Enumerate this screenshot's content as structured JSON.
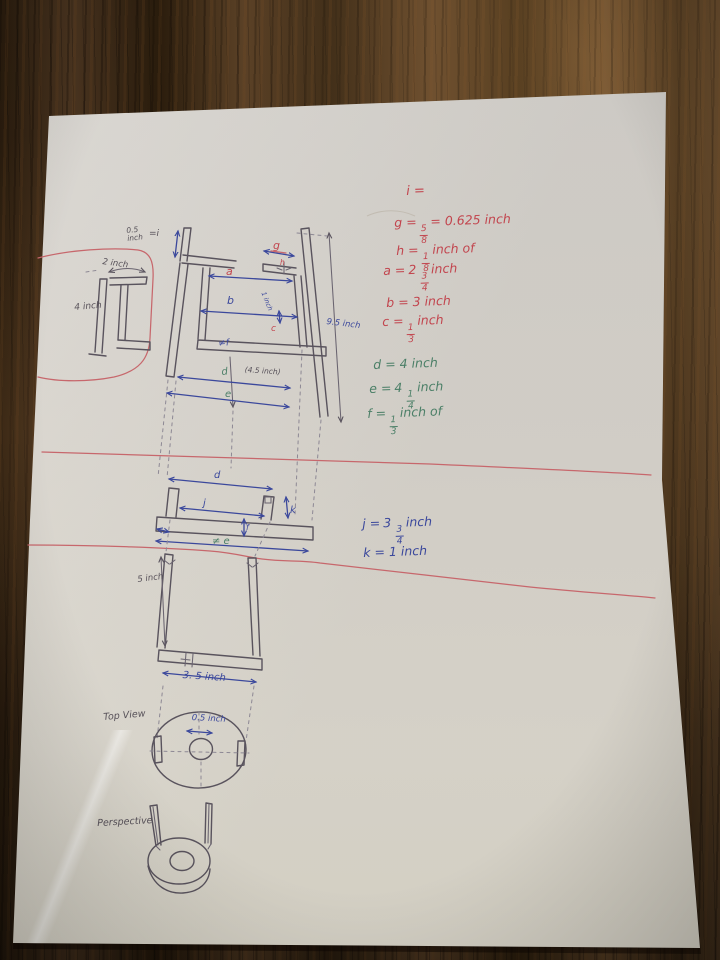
{
  "colors": {
    "ink": "#59535d",
    "dimension_blue": "#3b489c",
    "legend_red": "#c2454e",
    "legend_green": "#4b7f67",
    "red_marker_line": "#c7676c",
    "paper": "#dcd8d1",
    "wood": "#3a2a1a"
  },
  "legend": {
    "red": {
      "i": {
        "pre": "i ="
      },
      "g": {
        "pre": "g =",
        "num": "5",
        "den": "8",
        "post": "= 0.625 inch"
      },
      "h": {
        "pre": "h =",
        "num": "1",
        "den": "8",
        "post": "inch of"
      },
      "a": {
        "pre": "a =",
        "whole": "2",
        "num": "3",
        "den": "4",
        "post": "inch"
      },
      "b": {
        "pre": "b =",
        "post": "3 inch"
      },
      "c": {
        "pre": "c =",
        "num": "1",
        "den": "3",
        "post": "inch"
      }
    },
    "green": {
      "d": {
        "pre": "d =",
        "post": "4 inch"
      },
      "e": {
        "pre": "e =",
        "whole": "4",
        "num": "1",
        "den": "4",
        "post": "inch"
      },
      "f": {
        "pre": "f =",
        "num": "1",
        "den": "3",
        "post": "inch of"
      }
    },
    "blue": {
      "j": {
        "pre": "j =",
        "whole": "3",
        "num": "3",
        "den": "4",
        "post": "inch"
      },
      "k": {
        "pre": "k =",
        "post": "1 inch"
      }
    }
  },
  "labels": {
    "detail": {
      "width": "2 inch",
      "height": "4 inch"
    },
    "front": {
      "i_mark": "=i",
      "note_05": "0.5\ninch",
      "a": "a",
      "b": "b",
      "g": "g",
      "h": "h",
      "one_inch": "1 inch",
      "c": "c",
      "f_mark": "≠f",
      "d": "d",
      "d_note": "(4.5 inch)",
      "e": "e",
      "height": "9.5 inch"
    },
    "section": {
      "d": "d",
      "j": "j",
      "k": "k",
      "f": "f",
      "e_mark": "≠ e"
    },
    "lower": {
      "height": "5 inch",
      "width": "3. 5 inch"
    },
    "top_view": {
      "title": "Top View",
      "hole": "0.5 inch"
    },
    "perspective": {
      "title": "Perspective"
    }
  }
}
